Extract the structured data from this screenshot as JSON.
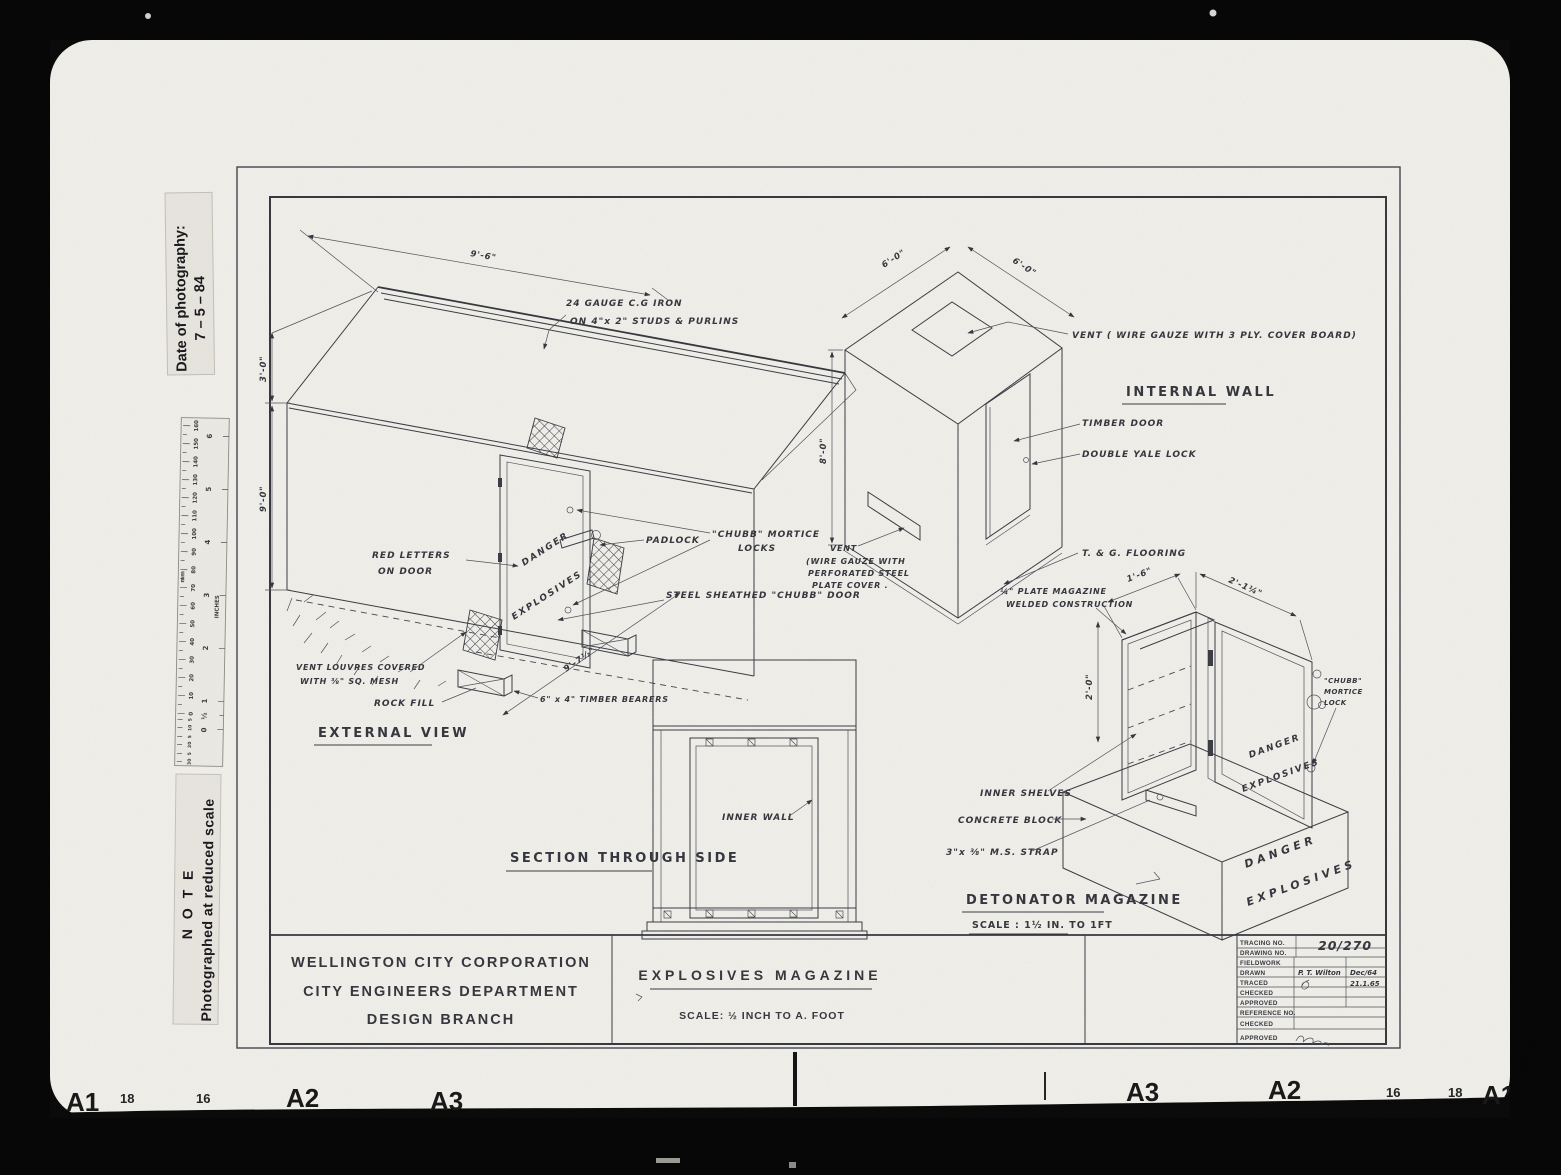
{
  "photo": {
    "date_label": {
      "line1": "Date of photography:",
      "line2": "7 – 5 – 84"
    },
    "note_label": {
      "line1": "N O T E",
      "line2": "Photographed at reduced scale"
    },
    "ruler": {
      "mm": "mm",
      "inches": "INCHES",
      "half": "½",
      "zero": "0",
      "mm_ticks": [
        "160",
        "150",
        "140",
        "130",
        "120",
        "110",
        "100",
        "90",
        "80",
        "70",
        "60",
        "50",
        "40",
        "30",
        "20",
        "10",
        "0"
      ],
      "sub_ticks": [
        "5",
        "10",
        "5",
        "20",
        "5",
        "30"
      ],
      "inch_ticks": [
        "6",
        "5",
        "4",
        "3",
        "2",
        "1"
      ]
    },
    "edge_marks": {
      "l1": "A1",
      "l2": "18",
      "l3": "16",
      "l4": "A2",
      "l5": "A3",
      "r1": "A3",
      "r2": "A2",
      "r3": "16",
      "r4": "18",
      "r5": "A1"
    }
  },
  "sheet": {
    "external": {
      "title": "EXTERNAL  VIEW",
      "dim_roof": "9'-6\"",
      "cgi1": "24 GAUGE  C.G IRON",
      "cgi2": "ON  4\"x 2\"  STUDS  &  PURLINS",
      "dim_gable": "3'-0\"",
      "dim_wall": "9'-0\"",
      "red1": "RED  LETTERS",
      "red2": "ON  DOOR",
      "padlock": "PADLOCK",
      "chubb1": "\"CHUBB\"  MORTICE",
      "chubb2": "LOCKS",
      "steel": "STEEL  SHEATHED \"CHUBB\" DOOR",
      "louvres1": "VENT  LOUVRES  COVERED",
      "louvres2": "WITH  ⅜\" SQ. MESH",
      "rock": "ROCK  FILL",
      "bearers": "6\" x  4\"  TIMBER  BEARERS",
      "dim_base": "9'-7½\"",
      "danger1": "DANGER",
      "danger2": "EXPLOSIVES"
    },
    "internal": {
      "title": "INTERNAL  WALL",
      "dim_w1": "6'-0\"",
      "dim_w2": "6'-0\"",
      "dim_h": "8'-0\"",
      "vent_top": "VENT    ( WIRE  GAUZE  WITH  3 PLY.  COVER  BOARD)",
      "timber": "TIMBER  DOOR",
      "yale": "DOUBLE  YALE  LOCK",
      "vent1": "VENT",
      "vent2": "(WIRE GAUZE  WITH",
      "vent3": "PERFORATED  STEEL",
      "vent4": "PLATE  COVER .",
      "floor": "T. & G.  FLOORING"
    },
    "section": {
      "title": "SECTION  THROUGH  SIDE",
      "inner": "INNER   WALL"
    },
    "detonator": {
      "title": "DETONATOR   MAGAZINE",
      "scale": "SCALE : 1½ IN. TO  1FT",
      "plate1": "¼\" PLATE  MAGAZINE",
      "plate2": "WELDED  CONSTRUCTION",
      "dim_w1": "1'-6\"",
      "dim_w2": "2'-1¼\"",
      "dim_h": "2'-0\"",
      "chubb1": "\"CHUBB\"",
      "chubb2": "MORTICE",
      "chubb3": "LOCK",
      "shelves": "INNER  SHELVES",
      "concrete": "CONCRETE  BLOCK",
      "strap": "3\"x ⅜\" M.S.  STRAP",
      "danger1": "DANGER",
      "danger2": "EXPLOSIVES",
      "bdanger1": "DANGER",
      "bdanger2": "EXPLOSIVES"
    },
    "title_block": {
      "org1": "WELLINGTON  CITY  CORPORATION",
      "org2": "CITY  ENGINEERS  DEPARTMENT",
      "org3": "DESIGN  BRANCH",
      "drawing_title": "EXPLOSIVES    MAGAZINE",
      "scale": "SCALE: ½ INCH TO A. FOOT",
      "table": {
        "r1": "TRACING   NO.",
        "r1v": "20/270",
        "r2": "DRAWING   NO.",
        "r3": "FIELDWORK",
        "r4": "DRAWN",
        "r4v": "P. T. Wilton",
        "r4d": "Dec/64",
        "r5": "TRACED",
        "r5d": "21.1.65",
        "r6": "CHECKED",
        "r7": "APPROVED",
        "r8": "REFERENCE NO.",
        "r9": "CHECKED",
        "r10": "APPROVED"
      }
    }
  }
}
